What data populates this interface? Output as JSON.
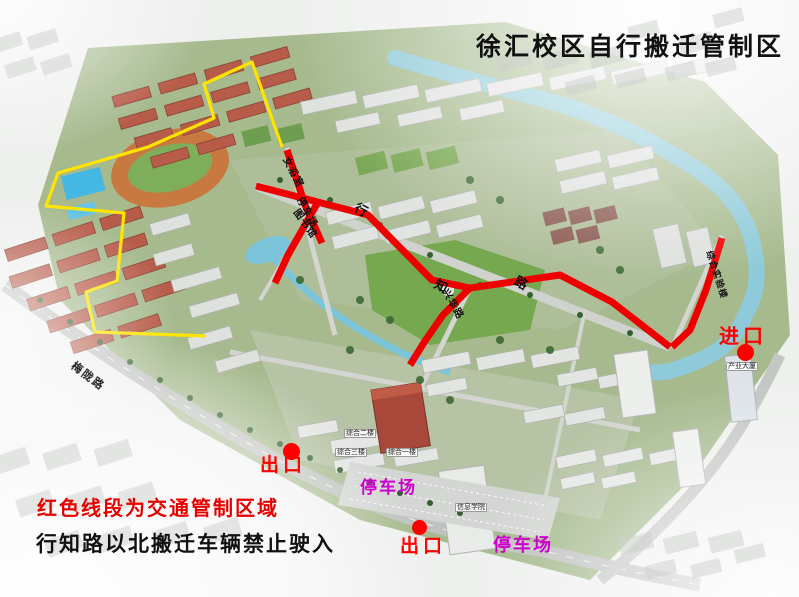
{
  "title": "徐汇校区自行搬迁管制区",
  "notice": {
    "line1": "红色线段为交通管制区域",
    "line2": "行知路以北搬迁车辆禁止驶入"
  },
  "gates": {
    "entrance_east": "进口",
    "exit_west": "出口",
    "exit_south": "出口"
  },
  "parking": {
    "west_lot": "停车场",
    "east_lot": "停车场"
  },
  "roads": {
    "xingzhi_char_1": "行",
    "xingzhi_char_2": "知",
    "xingzhi_char_3": "路",
    "meilong": "梅陇路"
  },
  "map_labels": {
    "women_bath": "女浴室",
    "north_parking": "停车场",
    "library": "图书馆",
    "xinghua_road": "兴华路",
    "east_lane": "综合实验楼",
    "info_college": "信息学院",
    "complex_1": "综合一楼",
    "complex_2": "综合二楼",
    "complex_3": "综合三楼",
    "industry_tower": "产业大厦"
  },
  "colors": {
    "control_line": "#ee0000",
    "boundary_line": "#ffe400",
    "gate_label": "#ff0000",
    "parking_label": "#cc00cc",
    "notice_red": "#e60000",
    "title": "#111111"
  }
}
